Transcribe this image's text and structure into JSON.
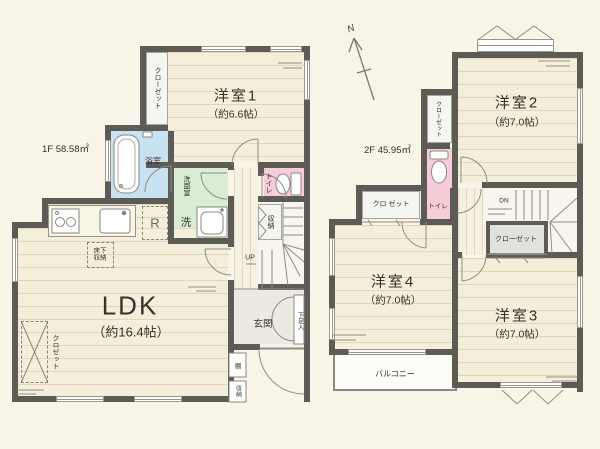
{
  "plan": {
    "f1": {
      "area": "1F 58.58㎡",
      "room1": "洋室1",
      "room1_size": "（約6.6帖）",
      "ldk": "LDK",
      "ldk_size": "（約16.4帖）",
      "bath": "浴室",
      "washroom": "洗面室",
      "washer": "洗",
      "fridge": "R",
      "toilet": "トイレ",
      "closet": "クローゼット",
      "hall_storage": "収納",
      "underfloor_storage": "床下収納",
      "ldk_closet": "クロゼット",
      "up": "UP",
      "genkan": "玄関",
      "shoe_storage": "下足入",
      "shelf": "棚",
      "porch_storage": "収納"
    },
    "f2": {
      "area": "2F 45.95㎡",
      "north": "N",
      "room2": "洋室2",
      "room2_size": "（約7.0帖）",
      "room3": "洋室3",
      "room3_size": "（約7.0帖）",
      "room4": "洋室4",
      "room4_size": "（約7.0帖）",
      "closet_west": "クローゼット",
      "closet_hall": "クロ ゼット",
      "closet_stairs": "クローゼット",
      "toilet": "トイレ",
      "balcony": "バルコニー",
      "dn": "DN"
    },
    "colors": {
      "wall": "#5c5b55",
      "wood_floor": "#f4efdb",
      "bath": "#c8e2f2",
      "washroom": "#daecd4",
      "toilet": "#f5ccd7",
      "background": "#f8f4e7"
    }
  }
}
